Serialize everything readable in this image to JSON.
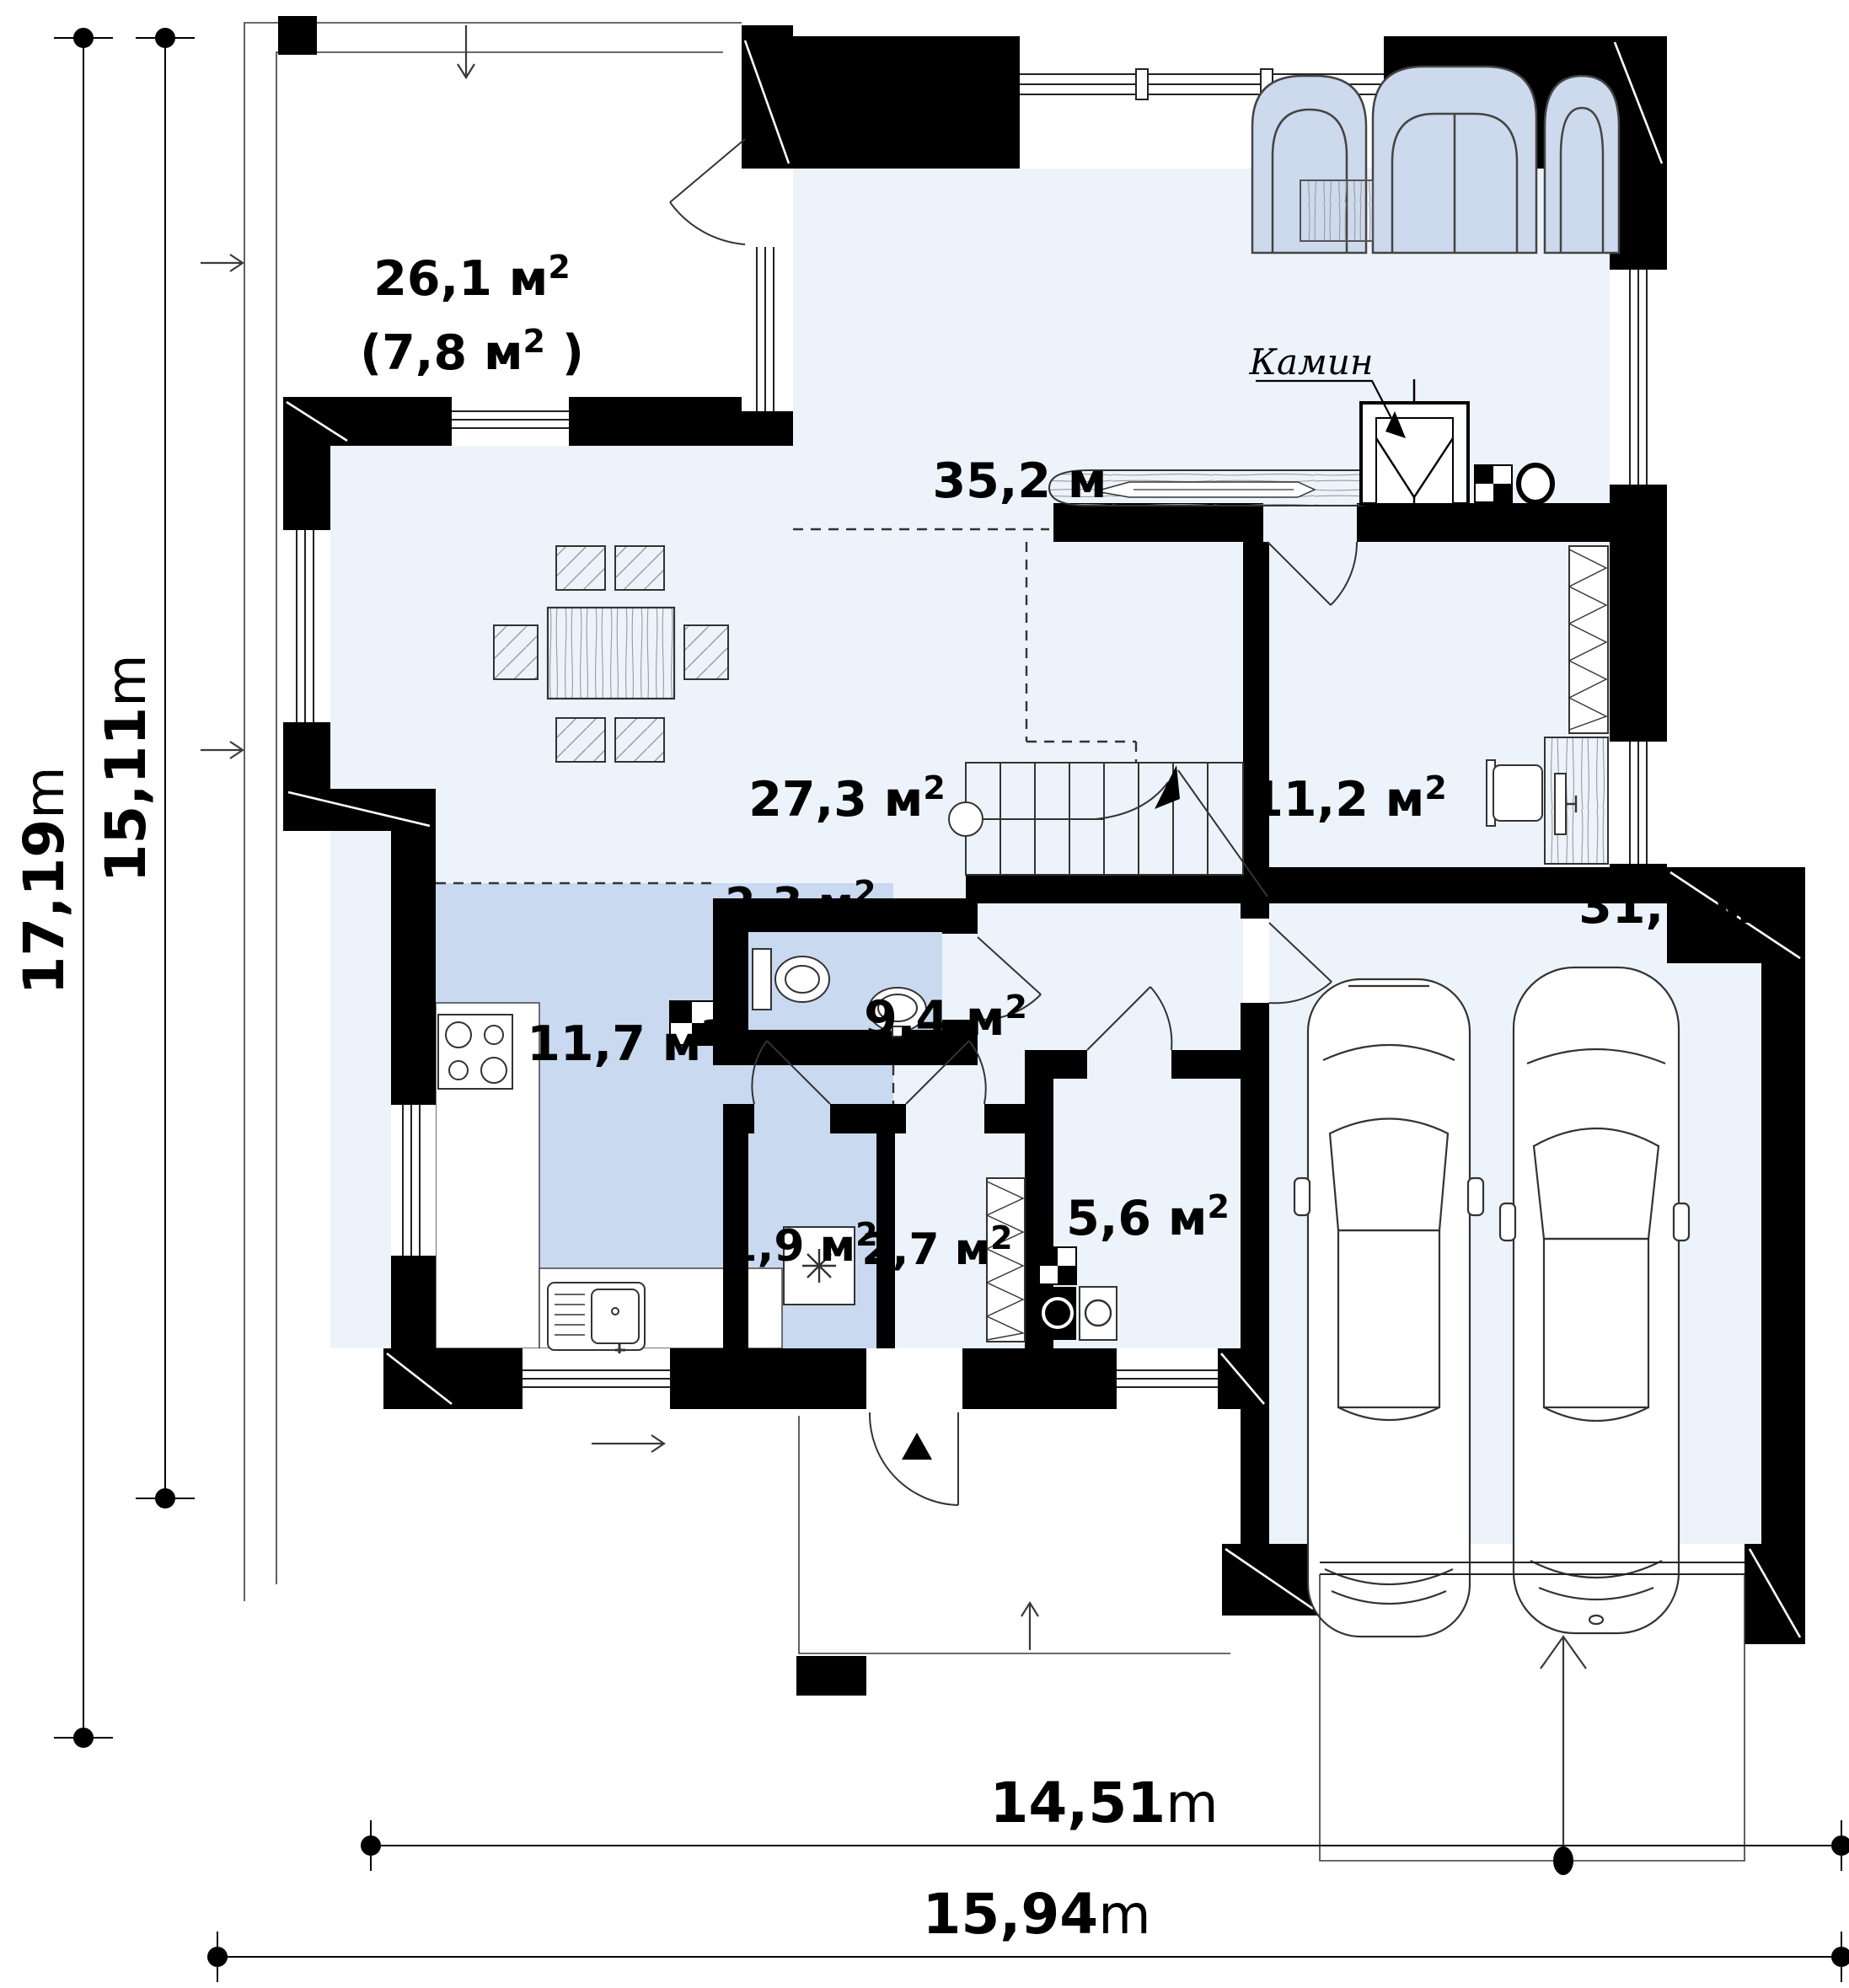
{
  "rooms": [
    {
      "id": "terrace",
      "area": "26,1 м",
      "sup": "2",
      "close": ""
    },
    {
      "id": "terrace-covered",
      "area": "(7,8 м",
      "sup": "2",
      "close": " )"
    },
    {
      "id": "living-room",
      "area": "35,2 м",
      "sup": ""
    },
    {
      "id": "dining-room",
      "area": "27,3 м",
      "sup": "2"
    },
    {
      "id": "office",
      "area": "11,2 м",
      "sup": "2"
    },
    {
      "id": "wc",
      "area": "2,3 м",
      "sup": "2"
    },
    {
      "id": "kitchen",
      "area": "11,7 м",
      "sup": "2"
    },
    {
      "id": "hall",
      "area": "9,4 м",
      "sup": "2"
    },
    {
      "id": "storage-small",
      "area": "1,9 м",
      "sup": "2"
    },
    {
      "id": "storage",
      "area": "2,7 м",
      "sup": "2"
    },
    {
      "id": "utility",
      "area": "5,6 м",
      "sup": "2"
    },
    {
      "id": "garage",
      "area": "31,2 м",
      "sup": "2"
    }
  ],
  "annotations": {
    "fireplace_label": "Камин"
  },
  "dimensions": {
    "left_outer": {
      "value": "17,19",
      "unit": "m"
    },
    "left_inner": {
      "value": "15,11",
      "unit": "m"
    },
    "bottom_inner": {
      "value": "14,51",
      "unit": "m"
    },
    "bottom_outer": {
      "value": "15,94",
      "unit": "m"
    }
  },
  "colors": {
    "wall": "#000000",
    "floor_light": "#edf3fb",
    "floor_blue": "#c9d9f0",
    "sofa_fill": "#cdd9ec",
    "line": "#2a2a2a"
  }
}
